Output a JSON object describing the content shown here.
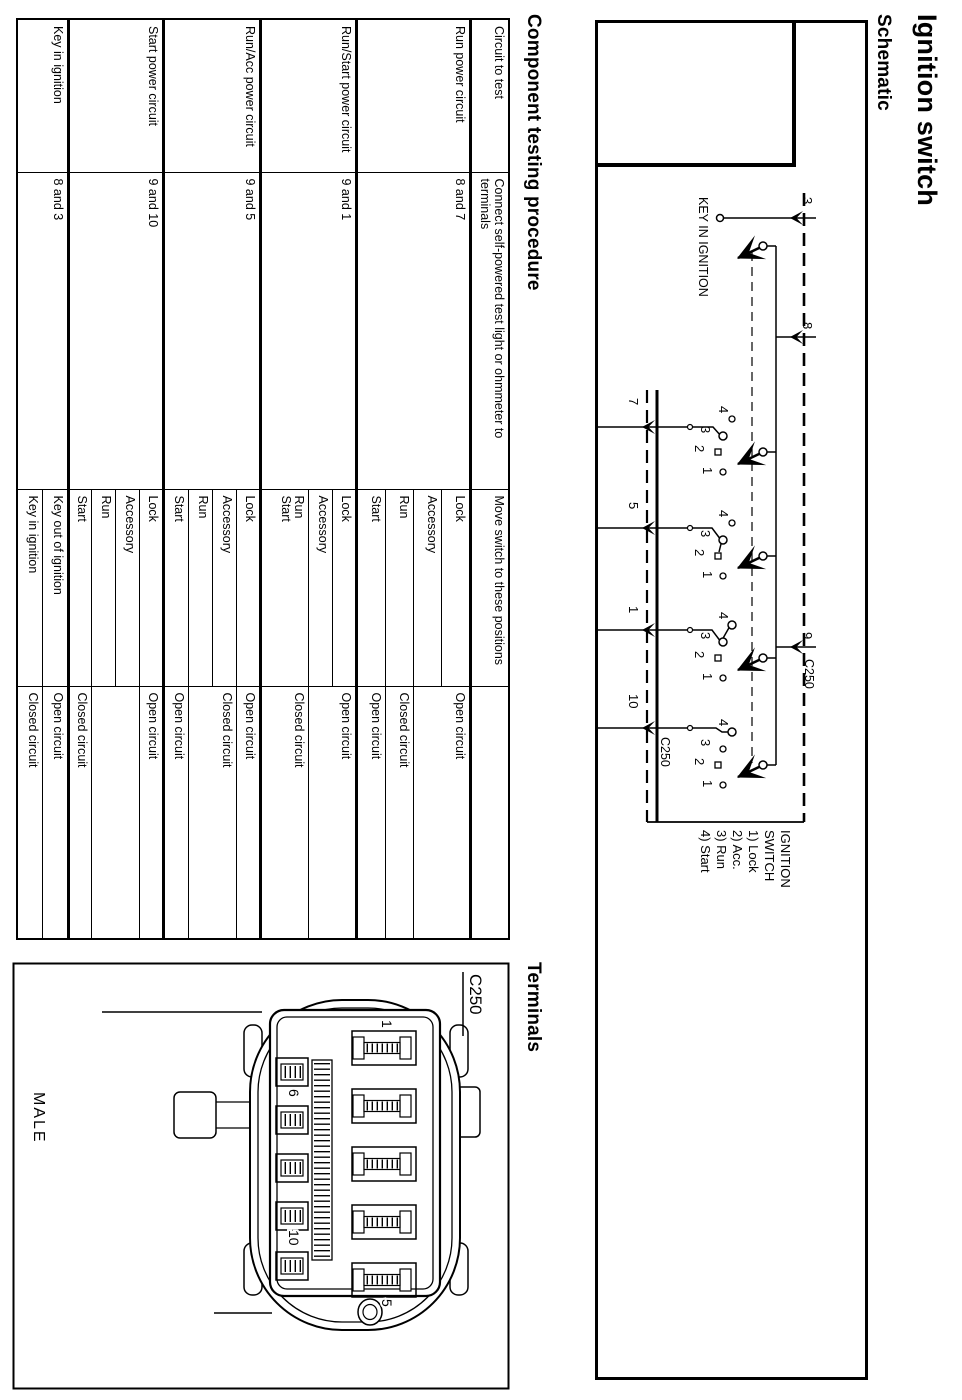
{
  "page": {
    "title": "Ignition switch",
    "schematic_heading": "Schematic",
    "testing_heading": "Component testing procedure",
    "terminals_heading": "Terminals"
  },
  "schematic": {
    "key_in_label": "KEY IN IGNITION",
    "connector": "C250",
    "top_terminals": [
      "3",
      "8",
      "9"
    ],
    "bottom_terminals": [
      "7",
      "5",
      "1",
      "10"
    ],
    "contact_labels": [
      "4",
      "3",
      "2",
      "1"
    ],
    "legend": [
      "IGNITION",
      "SWITCH",
      "1) Lock",
      "2) Acc.",
      "3) Run",
      "4) Start"
    ]
  },
  "testing_table": {
    "headers": [
      "Circuit to test",
      "Connect self-powered test light or ohmmeter to terminals",
      "Move switch to these positions",
      ""
    ],
    "rows": [
      {
        "circuit": "Run power circuit",
        "terminals": "8 and 7",
        "positions": [
          "Lock",
          "Accessory",
          "Run",
          "Start"
        ],
        "results": [
          "Open circuit",
          "Closed circuit",
          "Open circuit"
        ]
      },
      {
        "circuit": "Run/Start power circuit",
        "terminals": "9 and 1",
        "positions": [
          "Lock",
          "Accessory",
          "Run",
          "Start"
        ],
        "results": [
          "Open circuit",
          "Closed circuit"
        ]
      },
      {
        "circuit": "Run/Acc power circuit",
        "terminals": "9 and 5",
        "positions": [
          "Lock",
          "Accessory",
          "Run",
          "Start"
        ],
        "results": [
          "Open circuit",
          "Closed circuit",
          "Open circuit"
        ]
      },
      {
        "circuit": "Start power circuit",
        "terminals": "9 and 10",
        "positions": [
          "Lock",
          "Accessory",
          "Run",
          "Start"
        ],
        "results": [
          "Open circuit",
          "",
          "Closed circuit"
        ]
      },
      {
        "circuit": "Key in ignition",
        "terminals": "8 and 3",
        "positions": [
          "Key out of ignition",
          "Key in ignition"
        ],
        "results": [
          "Open circuit",
          "Closed circuit"
        ]
      }
    ]
  },
  "terminals_view": {
    "connector": "C250",
    "gender": "MALE",
    "pins": [
      "1",
      "5",
      "6",
      "10"
    ]
  }
}
